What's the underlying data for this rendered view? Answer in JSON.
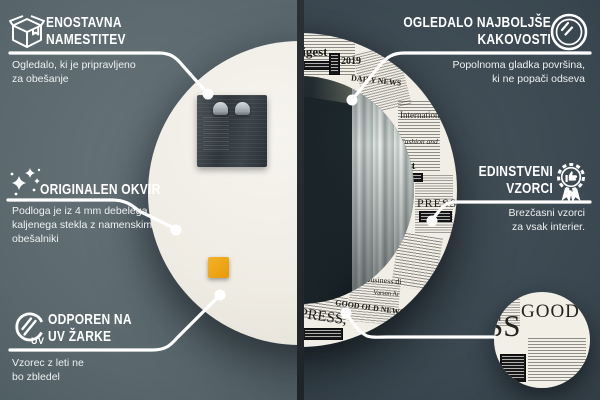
{
  "colors": {
    "accent_white": "#ffffff",
    "bg_left_photo": "#55646b",
    "bg_right_photo": "#323f47",
    "divider": "#23282b",
    "newsprint_paper": "#f1eee6",
    "newsprint_ink": "#1d1d18",
    "mirror_back": "#f1efe8",
    "adhesive_pad_orange": "#eda414"
  },
  "callouts": {
    "install": {
      "icon": "package-box-icon",
      "title": "ENOSTAVNA\nNAMESTITEV",
      "desc": "Ogledalo, ki je pripravljeno\nza obešanje"
    },
    "quality": {
      "icon": "round-mirror-icon",
      "title": "OGLEDALO NAJBOLJŠE\nKAKOVOSTI",
      "desc": "Popolnoma gladka površina,\nki ne popači odseva"
    },
    "frame": {
      "icon": "sparkles-icon",
      "title": "ORIGINALEN OKVIR",
      "desc": "Podloga je iz 4 mm debelega\nkaljenega stekla z namenskimi\nobešalniki"
    },
    "patterns": {
      "icon": "award-badge-icon",
      "title": "EDINSTVENI\nVZORCI",
      "desc": "Brezčasni vzorci\nza vsak interier."
    },
    "uv": {
      "icon": "uv-rays-icon",
      "label": "UV",
      "title": "ODPOREN NA\nUV ŽARKE",
      "desc": "Vzorec z leti ne\nbo zbledel"
    }
  },
  "newsprint": {
    "digest": "digest",
    "year": "2019",
    "daily_news": "DAILY NEWS",
    "international": "International",
    "fashion": "Fashion and",
    "gest": "gest",
    "press_side": "PRESS",
    "business": "Business di",
    "varson": "Varson Ar",
    "good_old": "GOOD OLD NEWS",
    "press_bottom": "PRESS,",
    "bubble_ss": "SS",
    "bubble_good": "GOOD"
  }
}
